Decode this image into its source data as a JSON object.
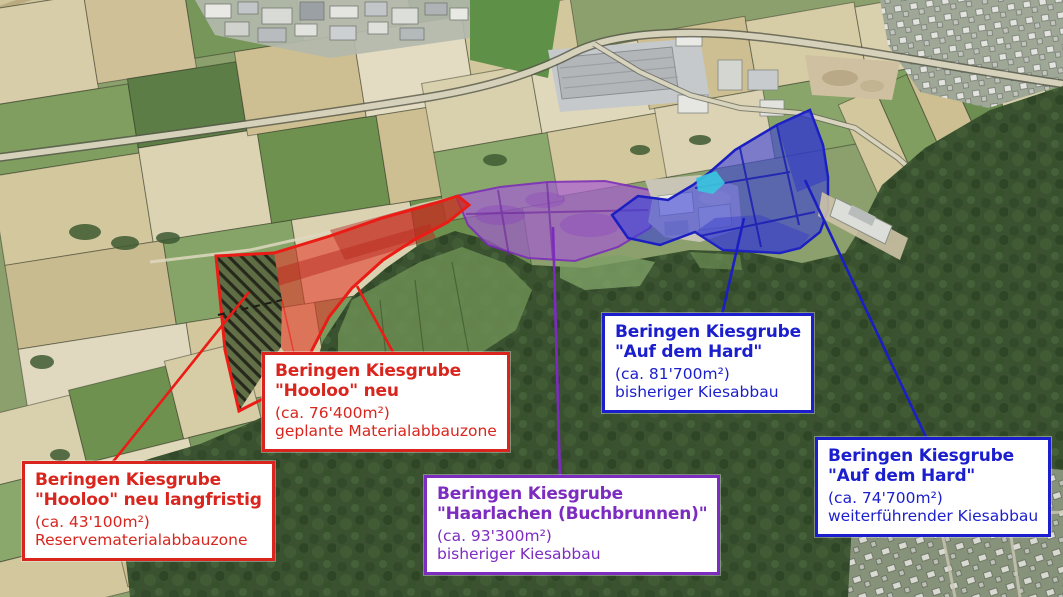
{
  "map_subject": "Beringen Kiesgrube Abbauzonen (aerial overview)",
  "legend_colors": {
    "red_zone": "#e02317",
    "purple_zone": "#8a2fd0",
    "blue_zone": "#1b1ecc",
    "pond": "#38c6de"
  },
  "labels": [
    {
      "id": "hooloo-neu-langfristig",
      "color": "#d9251d",
      "title": "Beringen Kiesgrube",
      "subtitle": "\"Hooloo\" neu langfristig",
      "area": "(ca. 43'100m²)",
      "type": "Reservematerialabbauzone"
    },
    {
      "id": "hooloo-neu",
      "color": "#d9251d",
      "title": "Beringen Kiesgrube",
      "subtitle": "\"Hooloo\" neu",
      "area": "(ca. 76'400m²)",
      "type": "geplante Materialabbauzone"
    },
    {
      "id": "haarlachen-buchbrunnen",
      "color": "#7d2cc0",
      "title": "Beringen Kiesgrube",
      "subtitle": "\"Haarlachen (Buchbrunnen)\"",
      "area": "(ca. 93'300m²)",
      "type": "bisheriger Kiesabbau"
    },
    {
      "id": "auf-dem-hard-bisher",
      "color": "#1b1ecc",
      "title": "Beringen Kiesgrube",
      "subtitle": "\"Auf dem Hard\"",
      "area": "(ca. 81'700m²)",
      "type": "bisheriger Kiesabbau"
    },
    {
      "id": "auf-dem-hard-weiter",
      "color": "#1b1ecc",
      "title": "Beringen Kiesgrube",
      "subtitle": "\"Auf dem Hard\"",
      "area": "(ca. 74'700m²)",
      "type": "weiterführender Kiesabbau"
    }
  ]
}
